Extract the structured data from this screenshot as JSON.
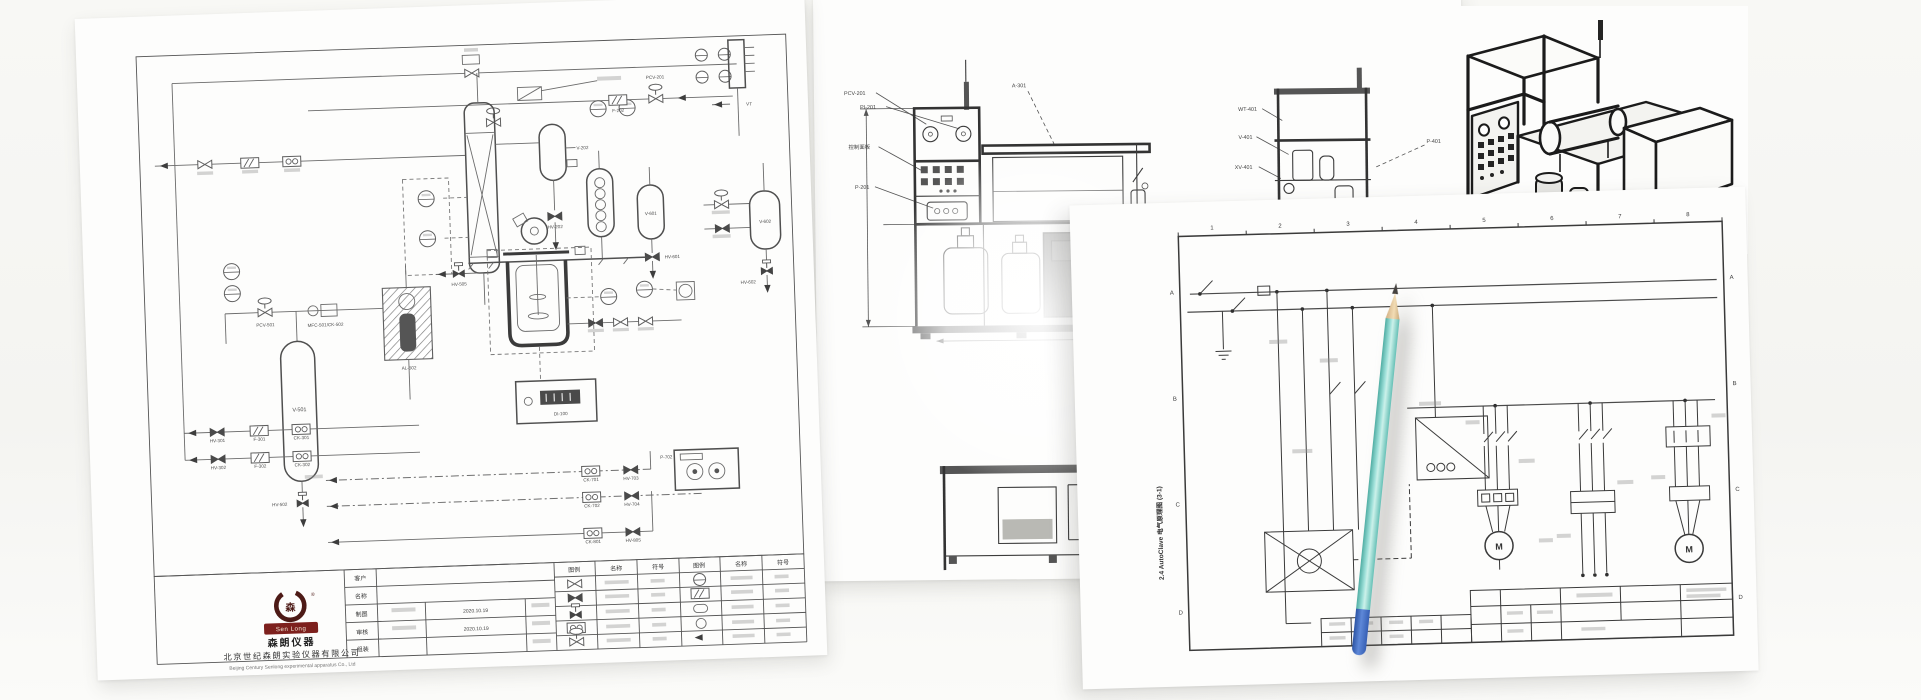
{
  "pid": {
    "tags": {
      "v501": "V-501",
      "hv502": "HV-502",
      "v202": "V-202",
      "hv202": "HV-202",
      "pcv201": "PCV-201",
      "f202": "F-202",
      "v601": "V-601",
      "hv601": "HV-601",
      "v602": "V-602",
      "hv602": "HV-602",
      "vt": "VT",
      "pcv501": "PCV-501",
      "mfc501": "MFC-501/CK-502",
      "al502": "AL-502",
      "di100": "DI-100",
      "hv505": "HV-505",
      "hv301": "HV-301",
      "f301": "F-301",
      "ck301": "CK-301",
      "hv302": "HV-302",
      "f302": "F-302",
      "ck302": "CK-302",
      "ck701": "CK-701",
      "hv703": "HV-703",
      "ck702": "CK-702",
      "hv704": "HV-704",
      "p702": "P-702",
      "ck801": "CK-801",
      "hv805": "HV-805"
    },
    "titleblock": {
      "logo_en": "Sen Long",
      "reg": "®",
      "logo_glyph": "森",
      "brand_cn": "森朗仪器",
      "company_cn": "北京世纪森朗实验仪器有限公司",
      "company_en": "Beijing Century Senlong experimental apparatus Co., Ltd",
      "rows": [
        "客户",
        "名称",
        "制图",
        "审核",
        "组装"
      ],
      "draw_date": "2020.10.19",
      "check_date": "2020.10.19",
      "legend_headers": [
        "图例",
        "名称",
        "符号",
        "图例",
        "名称",
        "符号"
      ]
    }
  },
  "layout": {
    "labels": {
      "pcv201": "PCV-201",
      "pi201": "PI-201",
      "panel": "控制面板",
      "p201": "P-201",
      "a301": "A-301",
      "wt401": "WT-401",
      "v401": "V-401",
      "xv401": "XV-401",
      "p401": "P-401"
    }
  },
  "electrical": {
    "caption": "2.4 AutoClave 电气原理图 (3-1)",
    "cols": [
      "1",
      "2",
      "3",
      "4",
      "5",
      "6",
      "7",
      "8"
    ],
    "rows": [
      "A",
      "B",
      "C",
      "D"
    ],
    "motor": "M"
  }
}
